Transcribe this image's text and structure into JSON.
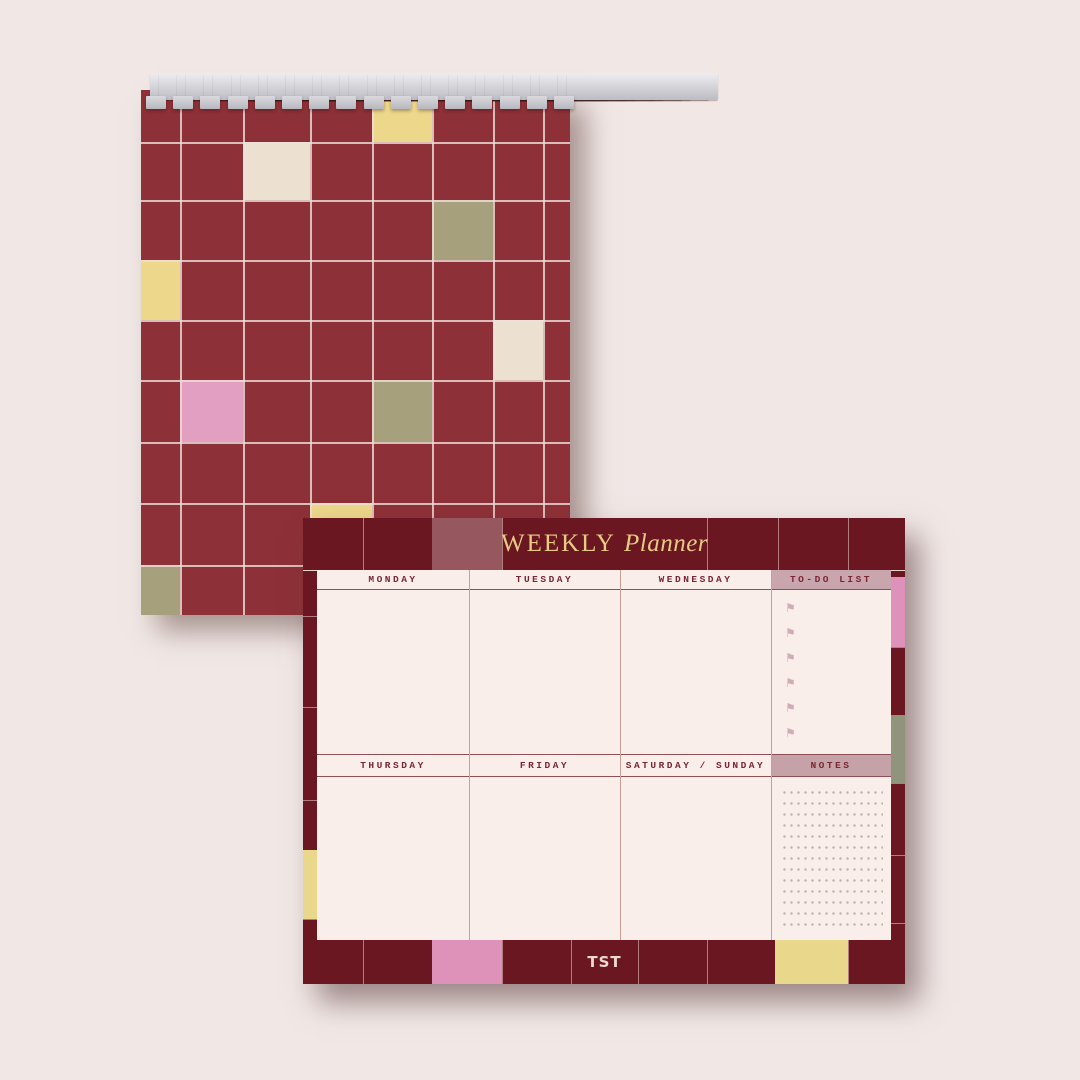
{
  "scene": {
    "description": "Stationery mockup: spiral grid notepad behind a weekly planner desk pad"
  },
  "colors": {
    "bg": "#f1e8e6",
    "nb_maroon": "#8e3038",
    "nb_line": "#eee0d9",
    "yellow": "#ecd78b",
    "cream": "#ece0d0",
    "olive": "#a6a17c",
    "pink": "#e29fc2",
    "p_maroon": "#6b1722",
    "p_line": "#ecd2cc",
    "mauve": "#96585e",
    "p_pink": "#de92ba",
    "p_yellow": "#e9d78c",
    "p_olive": "#8f947b",
    "gold": "#e6cb84",
    "content_bg": "#f9eee9",
    "text_maroon": "#7d2433",
    "sep": "#c9a096",
    "underline": "#8f4f56",
    "todo_mauve": "#c9a6ae",
    "notes_mauve": "#c5a2a7",
    "flag": "#d0acb9",
    "dot": "#c6b1ad",
    "brand_cream": "#eedacd"
  },
  "notebook": {
    "spiral_count": 16,
    "pattern_cells": [
      {
        "color": "yellow",
        "x": 231,
        "y": 0,
        "w": 60,
        "h": 52
      },
      {
        "color": "cream",
        "x": 102,
        "y": 52,
        "w": 67,
        "h": 58
      },
      {
        "color": "olive",
        "x": 291,
        "y": 110,
        "w": 61,
        "h": 60
      },
      {
        "color": "yellow",
        "x": 0,
        "y": 170,
        "w": 39,
        "h": 60
      },
      {
        "color": "cream",
        "x": 352,
        "y": 230,
        "w": 50,
        "h": 60
      },
      {
        "color": "pink",
        "x": 39,
        "y": 290,
        "w": 63,
        "h": 62
      },
      {
        "color": "olive",
        "x": 231,
        "y": 290,
        "w": 60,
        "h": 62
      },
      {
        "color": "yellow",
        "x": 169,
        "y": 413,
        "w": 62,
        "h": 62
      },
      {
        "color": "olive",
        "x": 0,
        "y": 475,
        "w": 39,
        "h": 50
      }
    ]
  },
  "planner": {
    "title_main": "WEEKLY",
    "title_accent": "Planner",
    "row1": [
      "MONDAY",
      "TUESDAY",
      "WEDNESDAY",
      "TO-DO LIST"
    ],
    "row2": [
      "THURSDAY",
      "FRIDAY",
      "SATURDAY / SUNDAY",
      "NOTES"
    ],
    "todo_flag_count": 6,
    "flag_glyph": "⚑",
    "brand": "TST",
    "border_cells": [
      {
        "color": "mauve",
        "x": 129,
        "y": 0,
        "w": 70,
        "h": 52
      },
      {
        "color": "p_pink",
        "x": 129,
        "y": 422,
        "w": 70,
        "h": 44
      },
      {
        "color": "p_yellow",
        "x": 472,
        "y": 422,
        "w": 73,
        "h": 44
      },
      {
        "color": "p_yellow",
        "x": 0,
        "y": 332,
        "w": 14,
        "h": 69
      },
      {
        "color": "p_pink",
        "x": 588,
        "y": 59,
        "w": 14,
        "h": 70
      },
      {
        "color": "p_olive",
        "x": 588,
        "y": 197,
        "w": 14,
        "h": 68
      }
    ]
  }
}
